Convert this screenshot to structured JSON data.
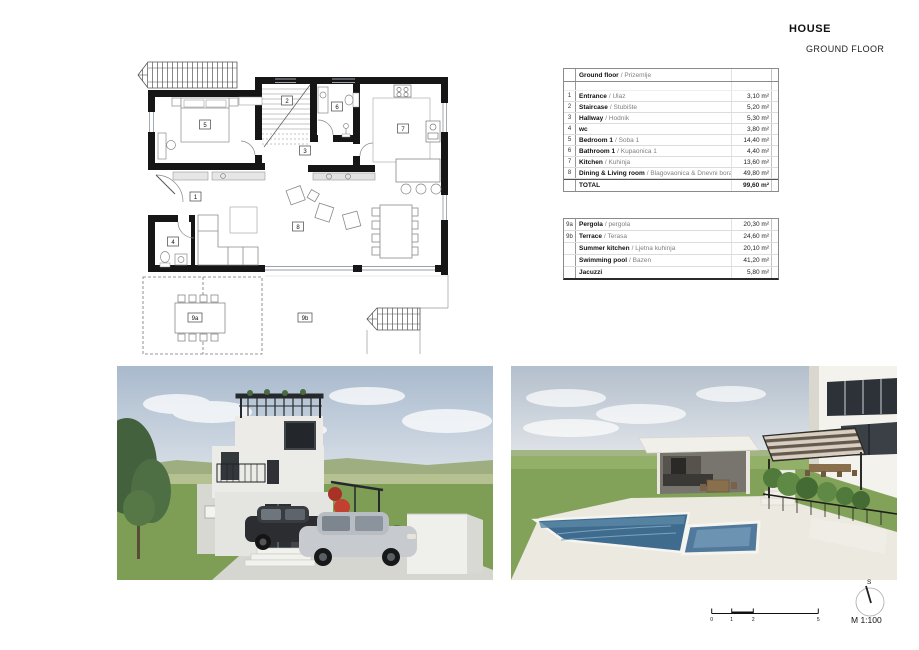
{
  "header": {
    "title": "HOUSE",
    "subtitle": "GROUND FLOOR"
  },
  "tables": {
    "ground": {
      "header": {
        "name": "Ground floor",
        "alt": "/ Prizemlje"
      },
      "rows": [
        {
          "num": "1",
          "name": "Entrance",
          "alt": "/ Ulaz",
          "area": "3,10 m²"
        },
        {
          "num": "2",
          "name": "Staircase",
          "alt": "/ Stubište",
          "area": "5,20 m²"
        },
        {
          "num": "3",
          "name": "Hallway",
          "alt": "/ Hodnik",
          "area": "5,30 m²"
        },
        {
          "num": "4",
          "name": "wc",
          "alt": "",
          "area": "3,80 m²"
        },
        {
          "num": "5",
          "name": "Bedroom 1",
          "alt": "/ Soba 1",
          "area": "14,40 m²"
        },
        {
          "num": "6",
          "name": "Bathroom 1",
          "alt": "/ Kupaonica 1",
          "area": "4,40 m²"
        },
        {
          "num": "7",
          "name": "Kitchen",
          "alt": "/ Kuhinja",
          "area": "13,60 m²"
        },
        {
          "num": "8",
          "name": "Dining & Living room",
          "alt": "/ Blagovaonica & Dnevni boravak",
          "area": "49,80 m²"
        }
      ],
      "total": {
        "label": "TOTAL",
        "area": "99,60 m²"
      }
    },
    "outdoor": {
      "rows": [
        {
          "num": "9a",
          "name": "Pergola",
          "alt": "/ pergola",
          "area": "20,30 m²"
        },
        {
          "num": "9b",
          "name": "Terrace",
          "alt": "/ Terasa",
          "area": "24,60 m²"
        },
        {
          "num": "",
          "name": "Summer kitchen",
          "alt": "/ Ljetna kuhinja",
          "area": "20,10 m²"
        },
        {
          "num": "",
          "name": "Swimming pool",
          "alt": "/ Bazen",
          "area": "41,20 m²"
        },
        {
          "num": "",
          "name": "Jacuzzi",
          "alt": "",
          "area": "5,80 m²"
        }
      ]
    }
  },
  "plan": {
    "labels": [
      "1",
      "2",
      "3",
      "4",
      "5",
      "6",
      "7",
      "8",
      "9a",
      "9b"
    ]
  },
  "scale": {
    "ticks": [
      "0",
      "1",
      "2",
      "5"
    ],
    "label": "M 1:100",
    "compass": "S"
  }
}
